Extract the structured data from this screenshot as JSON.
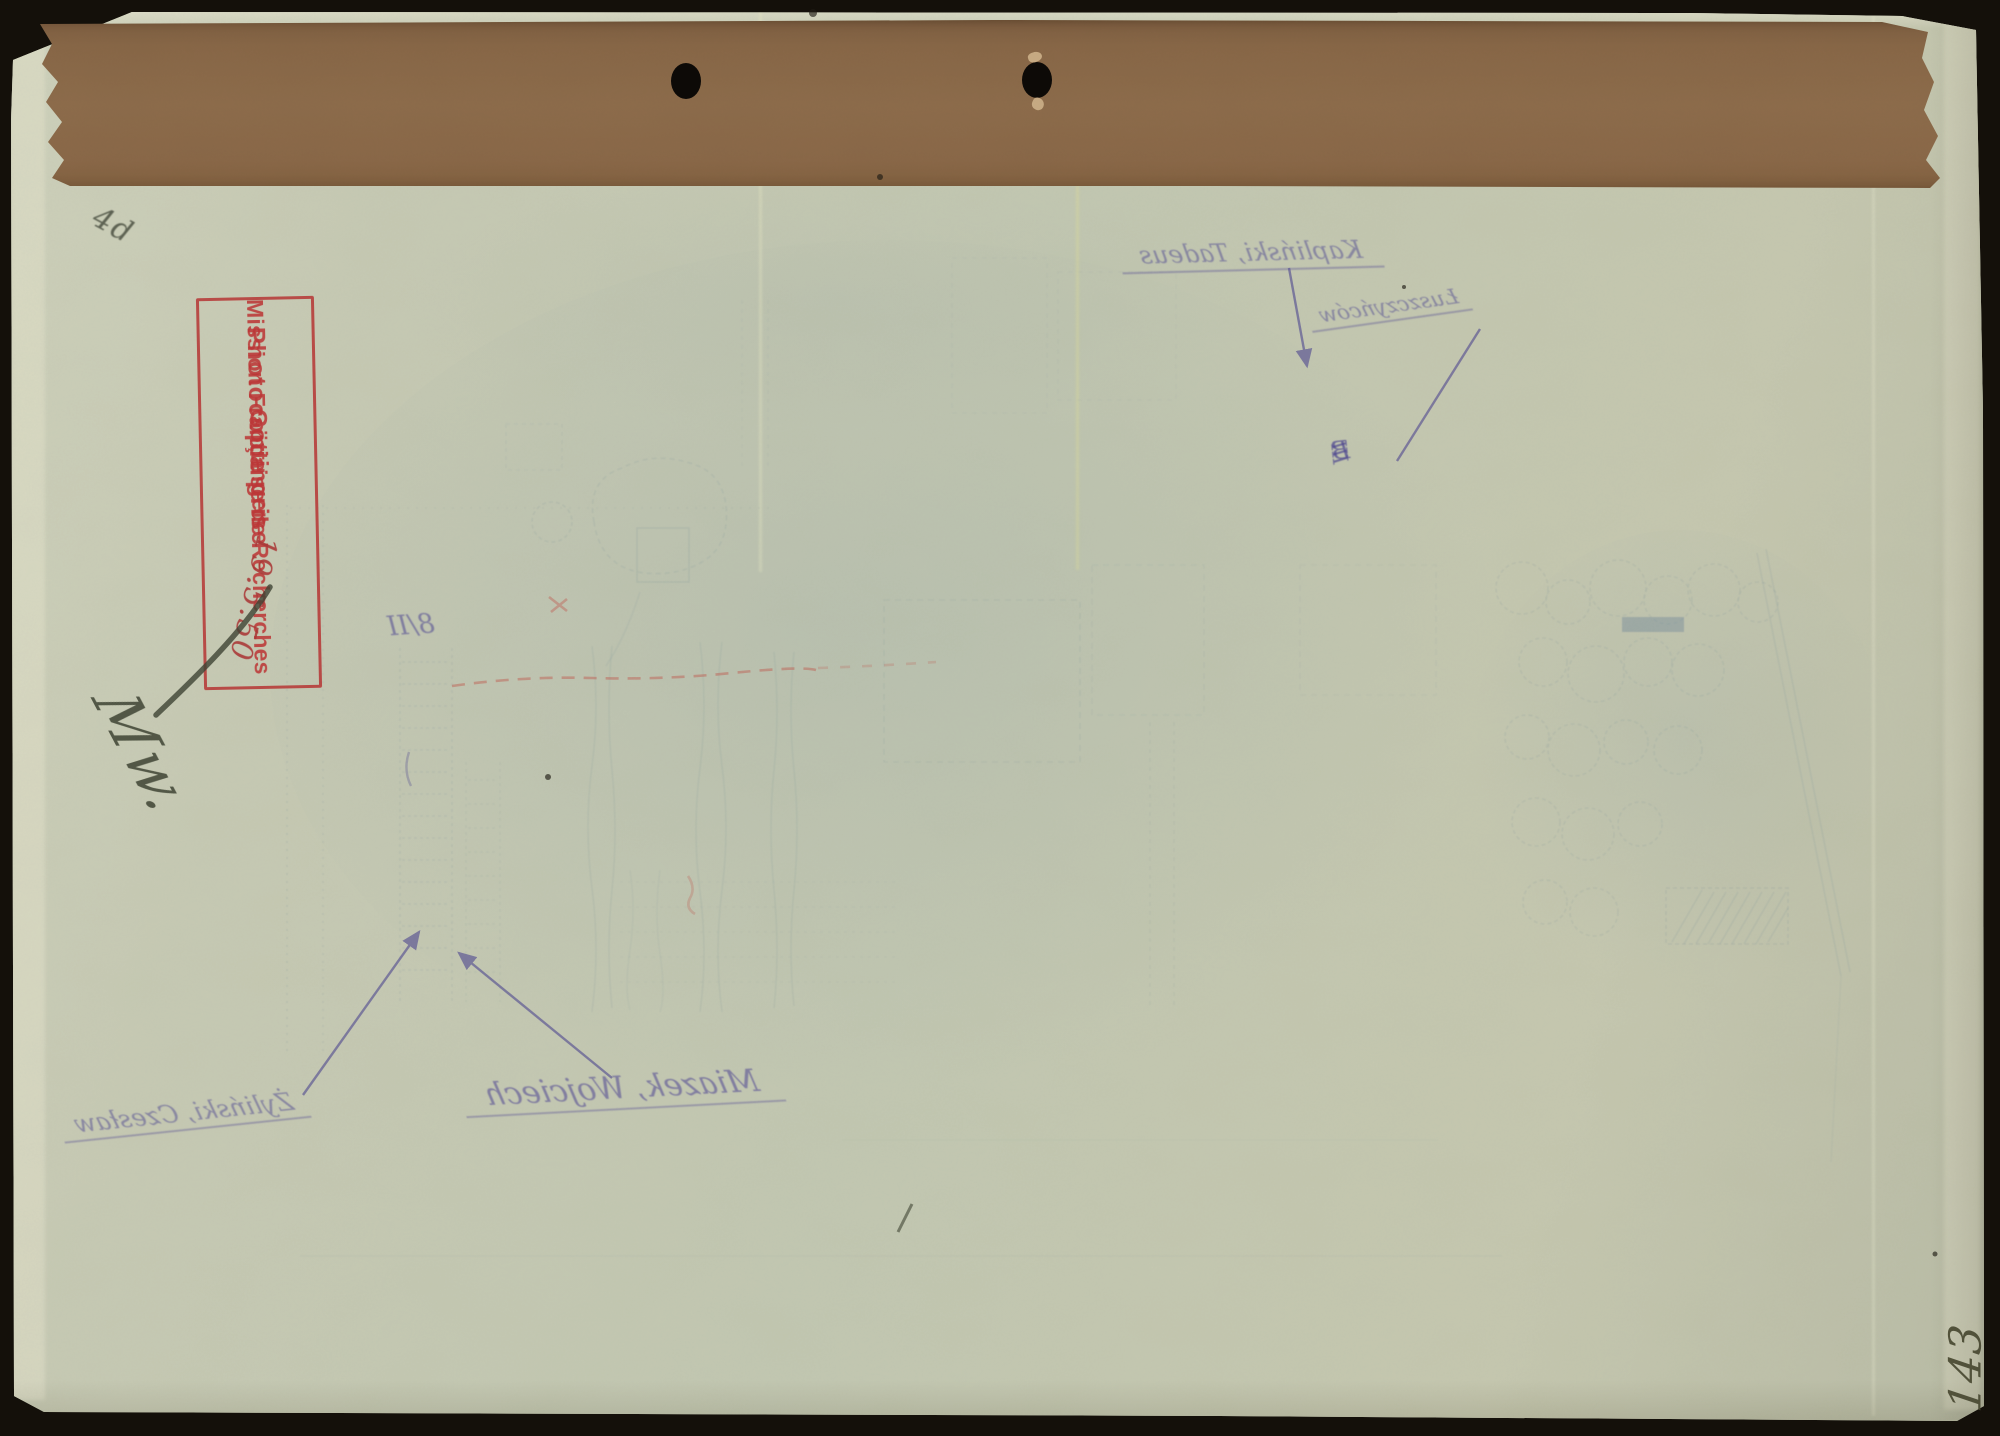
{
  "scan": {
    "background_color": "#14100a",
    "paper_color": "#c7cab4",
    "tape_color": "#8a6848",
    "stamp_ink_color": "#bf4040",
    "annotation_ink_color": "#5a5294",
    "plan_ink_color": "#7e97a2",
    "red_line_color": "#c2584e"
  },
  "stamp": {
    "line1": "Photocopie prise",
    "line2": "Mission Française de Recherches",
    "line3": "Göttingen",
    "handwritten_date": "19.5.50"
  },
  "handwriting": {
    "signature": "Mw.",
    "corner_scribble": "4d",
    "page_number": "143"
  },
  "mirrored_annotations": {
    "top_name": "Kapliński, Tadeus",
    "top_note": "Łuszczyńców",
    "sector_marker_b": "B",
    "sector_marker_b_numeral": "III",
    "sector_marker_8": "8/II",
    "bottom_name_1": "Miazek, Wojciech",
    "bottom_name_2": "Żyliński, Czesław"
  }
}
